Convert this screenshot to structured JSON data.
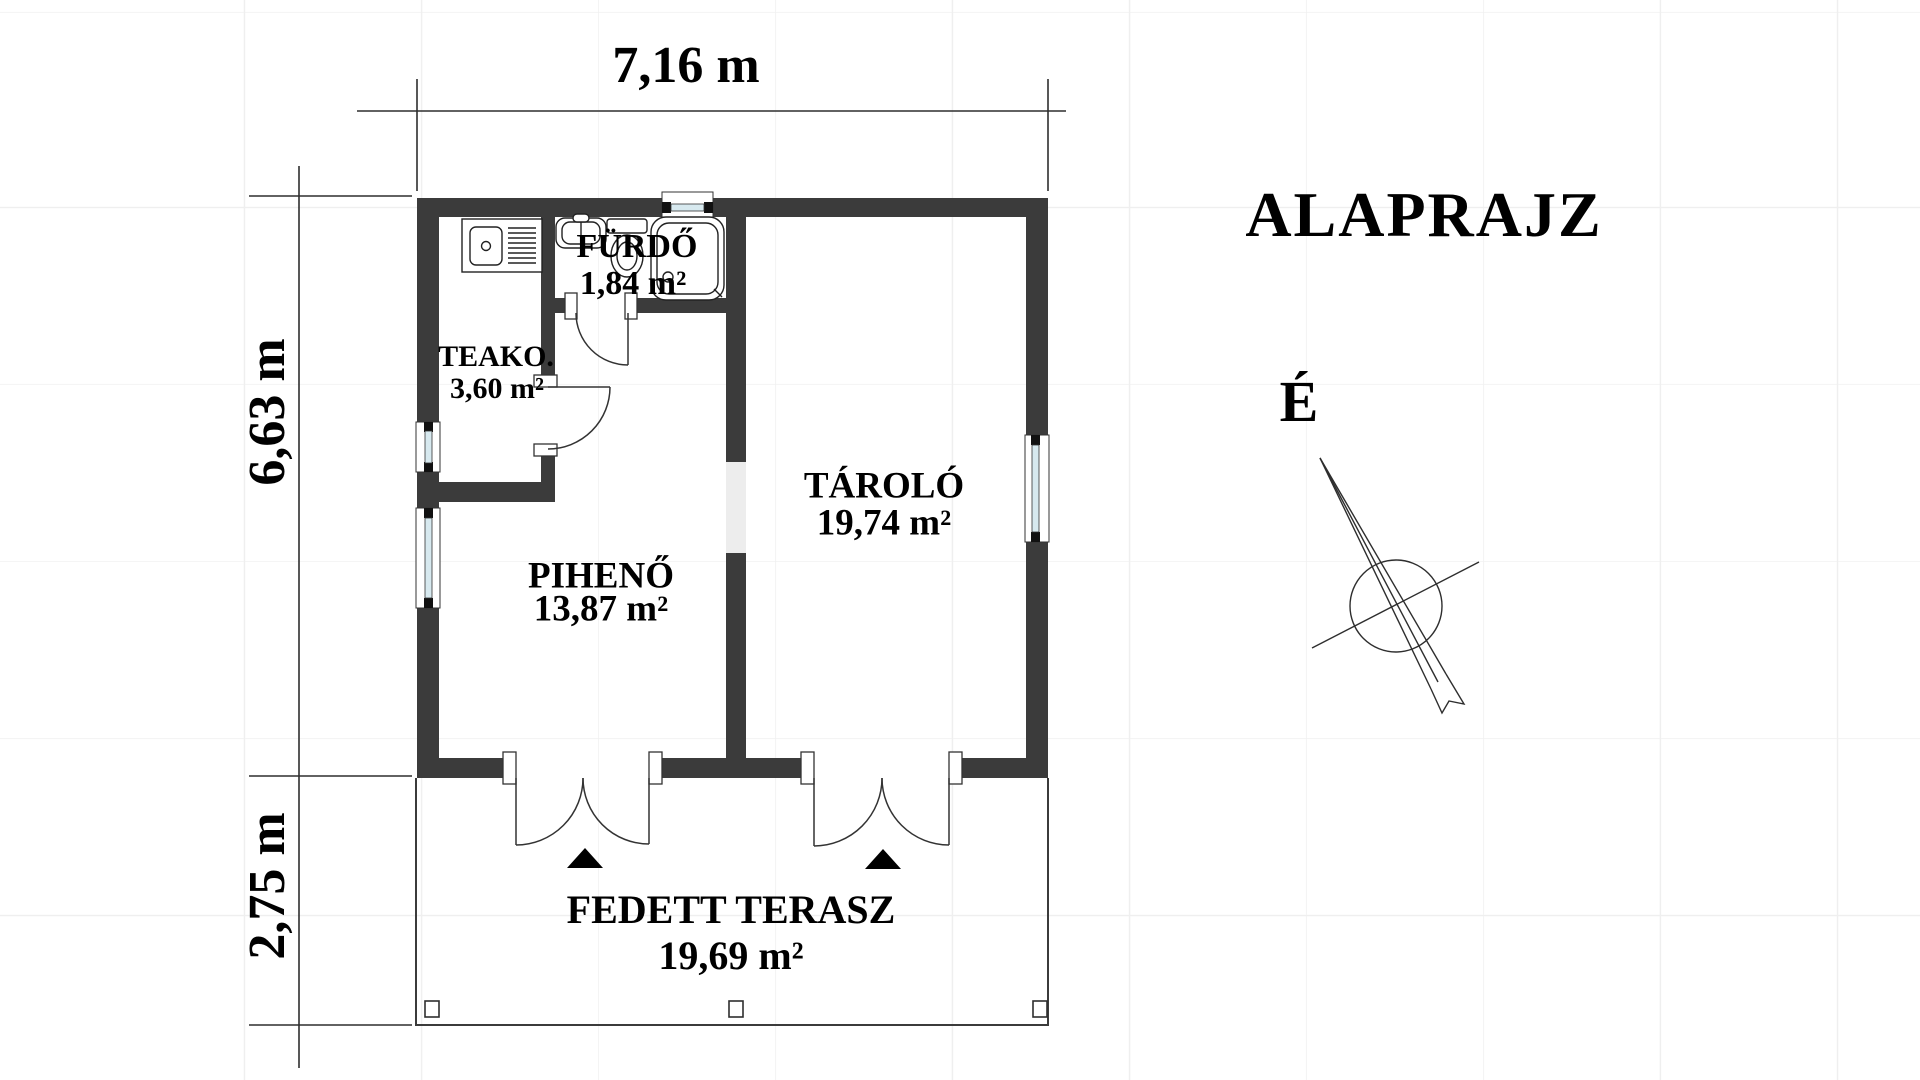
{
  "title": "ALAPRAJZ",
  "compass": {
    "north_label": "É"
  },
  "dimensions": {
    "building_width": "7,16 m",
    "building_height": "6,63 m",
    "terrace_depth": "2,75 m"
  },
  "rooms": {
    "teakonyha": {
      "name": "TEAKO.",
      "area": "3,60 m²"
    },
    "furdo": {
      "name": "FÜRDŐ",
      "area": "1,84 m²"
    },
    "tarolo": {
      "name": "TÁROLÓ",
      "area": "19,74 m²"
    },
    "piheno": {
      "name": "PIHENŐ",
      "area": "13,87 m²"
    },
    "terasz": {
      "name": "FEDETT TERASZ",
      "area": "19,69 m²"
    }
  },
  "colors": {
    "wall": "#3b3b3b",
    "line": "#2e2e2e",
    "glass": "#d7e9ef",
    "grid": "#efefef",
    "opening_fill": "#ededed"
  }
}
